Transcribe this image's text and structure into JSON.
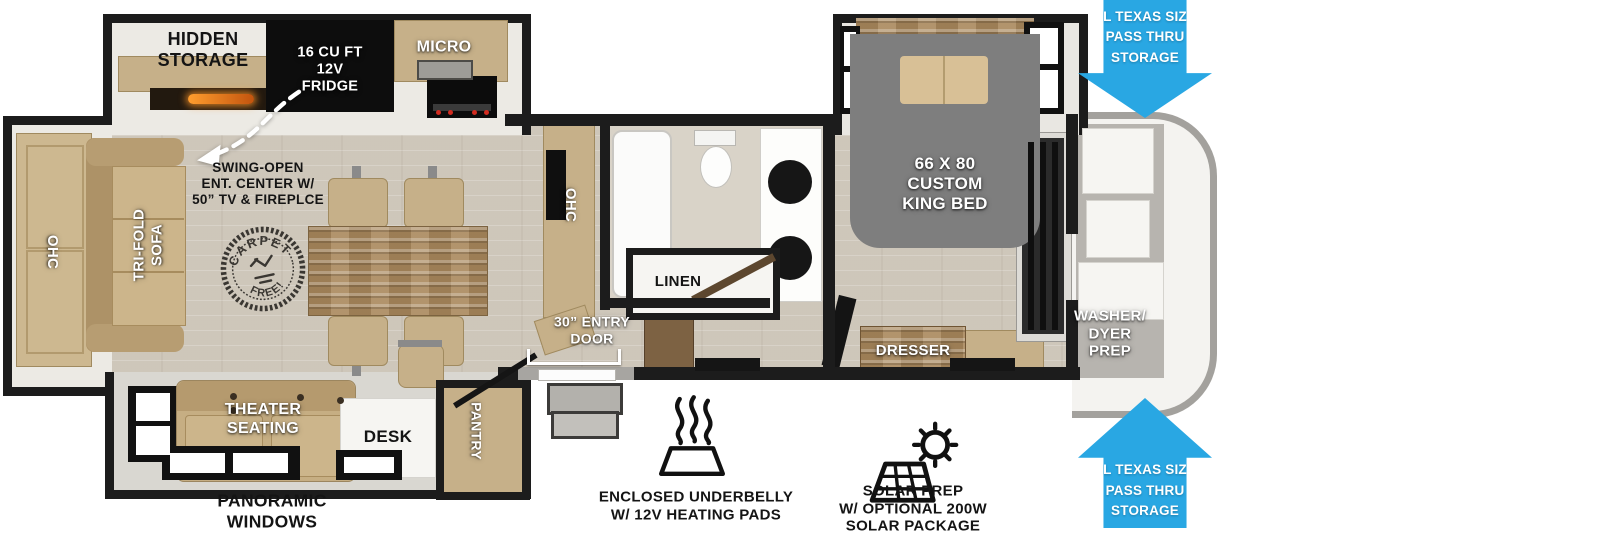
{
  "title": "Fifth-wheel RV floorplan diagram",
  "colors": {
    "accent_blue": "#29a7e3",
    "wall_black": "#1c1c1c",
    "bed_gray": "#7e7e7e",
    "floor_tan": "#d4cdc1",
    "furniture_tan": "#c6b089",
    "wood_brown": "#a9885c"
  },
  "kitchen": {
    "hidden_storage": "HIDDEN\nSTORAGE",
    "fridge": "16 CU FT\n12V\nFRIDGE",
    "micro": "MICRO",
    "ent_center_note": "SWING-OPEN\nENT. CENTER W/\n50” TV & FIREPLCE",
    "ohc": "OHC"
  },
  "living": {
    "rear_ohc": "OHC",
    "sofa": "TRI-FOLD\nSOFA",
    "carpet_stamp": {
      "top": "CARPET",
      "bottom": "FREE!"
    },
    "theater_seating": "THEATER\nSEATING",
    "desk": "DESK",
    "pantry": "PANTRY",
    "panoramic_windows": "PANORAMIC\nWINDOWS"
  },
  "bathroom": {
    "linen": "LINEN"
  },
  "bedroom": {
    "king_bed": "66 X 80\nCUSTOM\nKING BED",
    "dresser": "DRESSER"
  },
  "front": {
    "washer_dryer": "WASHER/\nDYER\nPREP",
    "pass_thru_top": "XL TEXAS SIZE\nPASS THRU\nSTORAGE",
    "pass_thru_bottom": "XL TEXAS SIZE\nPASS THRU\nSTORAGE"
  },
  "entry": {
    "door": "30” ENTRY\nDOOR"
  },
  "features": {
    "underbelly": "ENCLOSED UNDERBELLY\nW/ 12V HEATING PADS",
    "solar": "SOLAR PREP\nW/ OPTIONAL 200W\nSOLAR PACKAGE"
  },
  "icons": {
    "heating_pads": "waves-over-mat-icon",
    "solar_prep": "sun-over-panel-icon",
    "swing_open": "dashed-curved-arrow-icon",
    "pass_thru": "blue-directional-arrow"
  }
}
